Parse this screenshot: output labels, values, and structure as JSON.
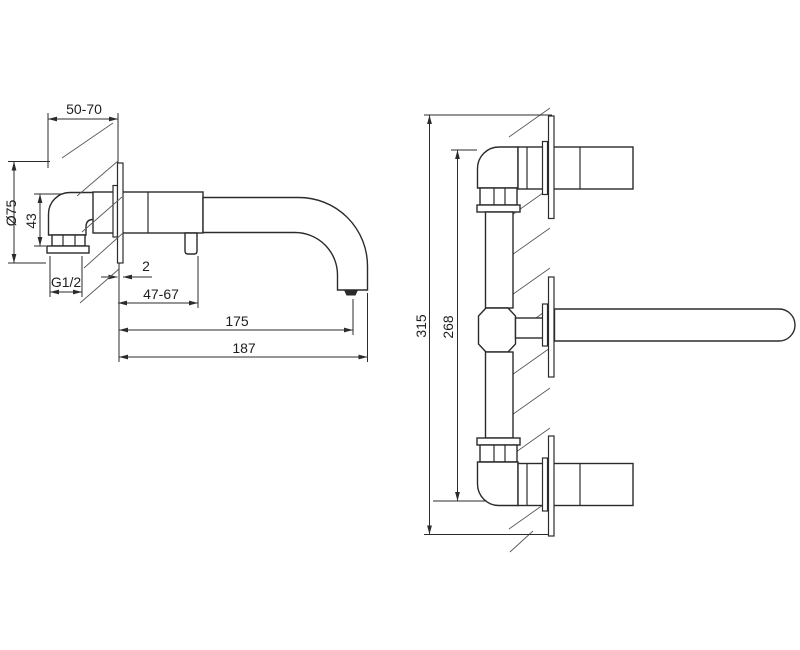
{
  "page": {
    "background": "#ffffff",
    "line_color": "#2b2b2b",
    "description": "Technical installation drawing of a wall-mounted basin faucet, side view and front view with dimensions in mm"
  },
  "side_view": {
    "name": "side-view",
    "labels": {
      "wall_depth_range": "50-70",
      "escutcheon_diameter": "Ø75",
      "elbow_height": "43",
      "thread_size": "G1/2",
      "escutcheon_thickness": "2",
      "spout_tip_range": "47-67",
      "spout_reach": "175",
      "total_projection": "187"
    }
  },
  "front_view": {
    "name": "front-view",
    "labels": {
      "total_height": "315",
      "valve_center_span": "268"
    }
  }
}
